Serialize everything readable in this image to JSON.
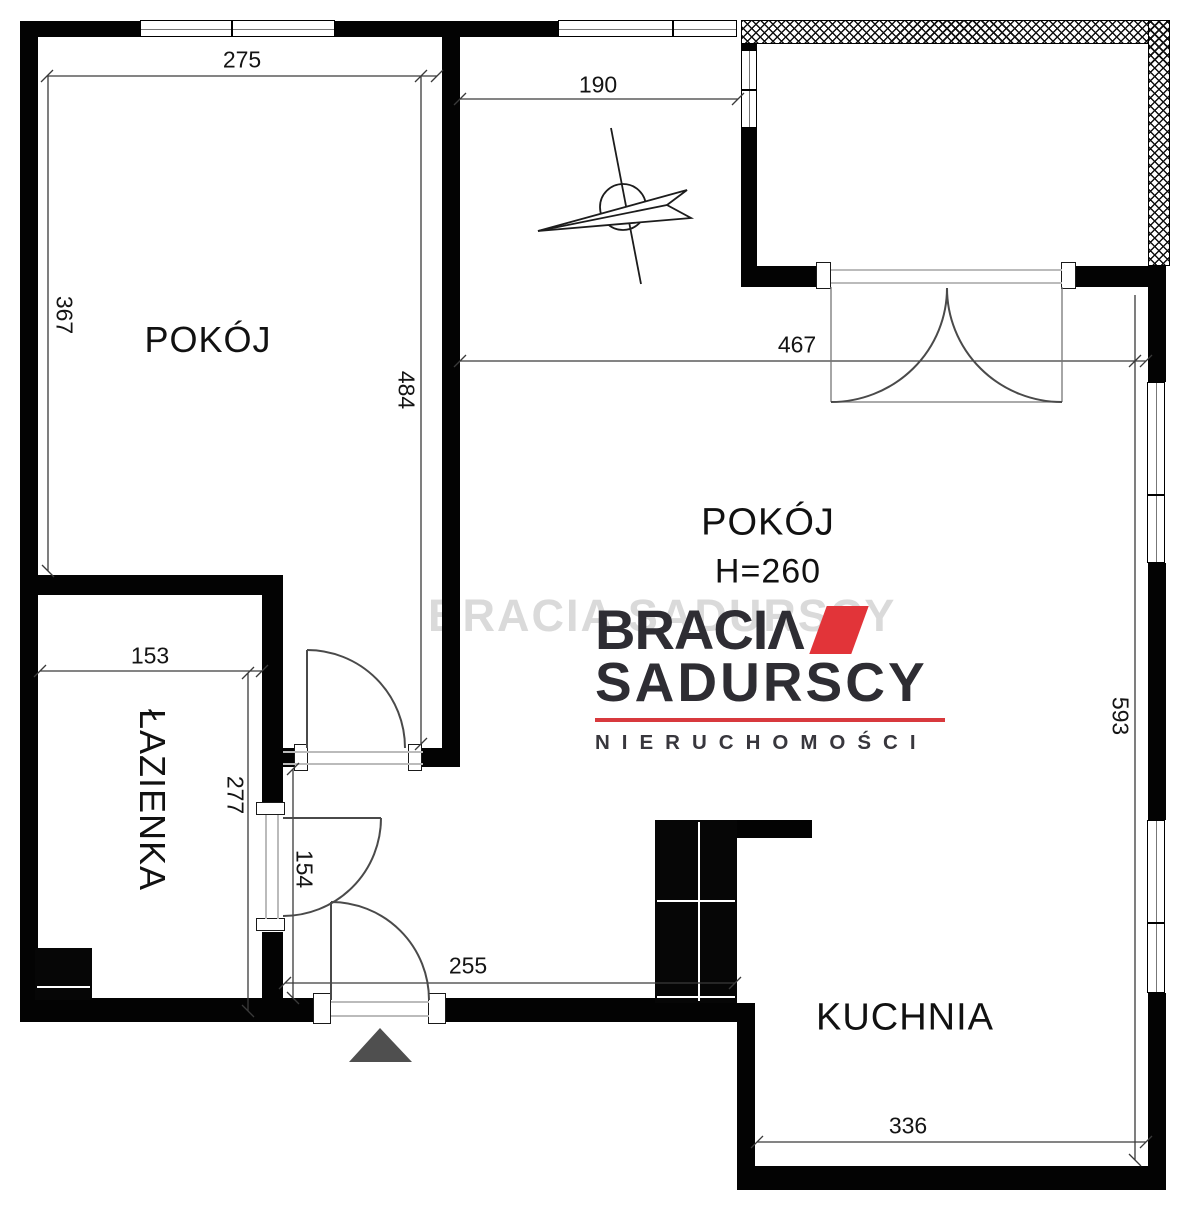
{
  "rooms": {
    "pokoj_left": {
      "label": "POKÓJ"
    },
    "pokoj_main": {
      "label": "POKÓJ",
      "height_note": "H=260"
    },
    "lazienka": {
      "label": "ŁAZIENKA"
    },
    "kuchnia": {
      "label": "KUCHNIA"
    }
  },
  "dimensions": {
    "top_width": "275",
    "left_room_height": "367",
    "left_room_full_height": "484",
    "top_opening_width": "190",
    "main_room_width": "467",
    "right_side_height": "593",
    "bathroom_width": "153",
    "bathroom_height": "277",
    "hall_length": "154",
    "hall_width": "255",
    "kitchen_width": "336"
  },
  "logo": {
    "brand_line1": "BRACIΛ",
    "brand_line2": "SADURSCY",
    "tagline": "NIERUCHOMOŚCI",
    "accent_color": "#e23439"
  },
  "watermark": {
    "text": "BRACIA SADURSCY"
  },
  "colors": {
    "wall": "#030303",
    "dim_line": "#3a3a3a",
    "door_arc": "#4a4a4a",
    "entrance_marker": "#4f4f4f"
  }
}
